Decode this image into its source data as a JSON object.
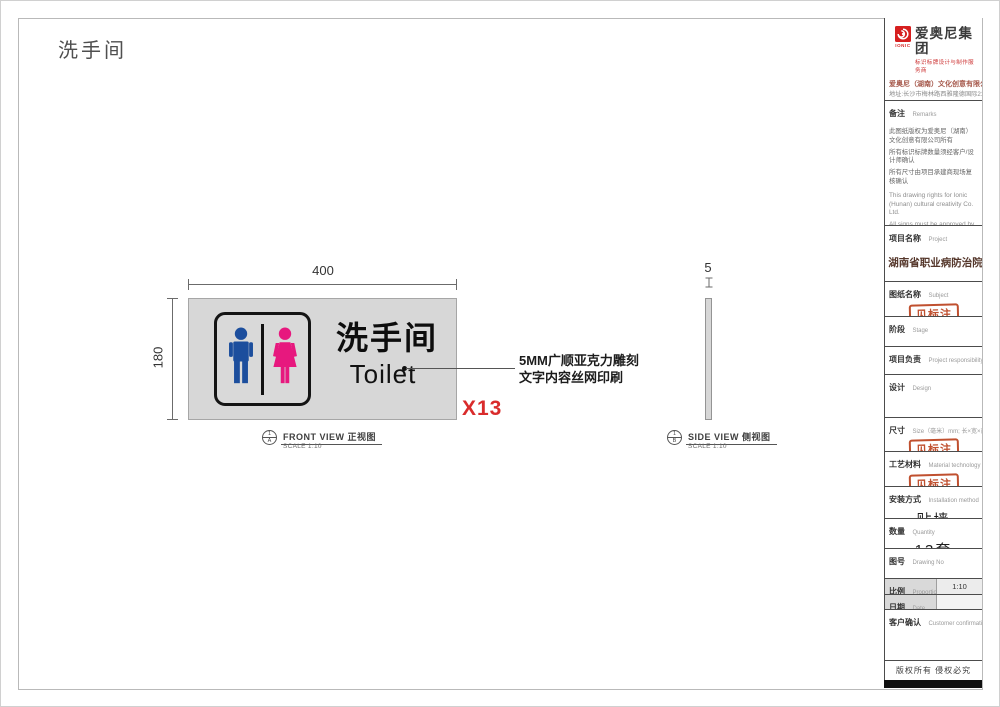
{
  "sheet": {
    "title": "洗手间"
  },
  "front_view": {
    "dim_width": "400",
    "dim_height": "180",
    "sign": {
      "cn": "洗手间",
      "en": "Toilet"
    },
    "annotation": {
      "line1": "5MM广顺亚克力雕刻",
      "line2": "文字内容丝网印刷"
    },
    "quantity_mark": "X13",
    "ref": {
      "num": "1",
      "letter": "A"
    },
    "label": "FRONT VIEW 正视图",
    "scale": "SCALE 1:10"
  },
  "side_view": {
    "dim_thickness": "5",
    "ref": {
      "num": "1",
      "letter": "B"
    },
    "label": "SIDE VIEW 侧视图",
    "scale": "SCALE 1:10"
  },
  "title_block": {
    "header": {
      "brand": "IONIC",
      "group_name": "爱奥尼集团",
      "tagline": "标识标牌设计与制作服务商",
      "company": "爱奥尼（湖南）文化创意有限公司",
      "address": "地址:长沙市梅林路西雅隆德国际2122室",
      "phone": "电话:0731-85074045",
      "website": "http://www.ionic.net.cn"
    },
    "remarks": {
      "label_cn": "备注",
      "label_en": "Remarks",
      "cn": [
        "此图纸版权为爱奥尼（湖南）文化创意有限公司所有",
        "所有标识标牌数量须经客户/设计师确认",
        "所有尺寸由项目承建商现场复核确认"
      ],
      "en": [
        "This drawing rights for Ionic (Hunan) cultural creativity Co. Ltd.",
        "All signs must be approved by the customer / designer to confirm the number of",
        "All dimensions by the project contractors on site review confirmed"
      ]
    },
    "project": {
      "label_cn": "项目名称",
      "label_en": "Project",
      "value": "湖南省职业病防治院"
    },
    "subject": {
      "label_cn": "图纸名称",
      "label_en": "Subject",
      "stamp": "见标注"
    },
    "stage": {
      "label_cn": "阶段",
      "label_en": "Stage",
      "value": ""
    },
    "responsibility": {
      "label_cn": "项目负责",
      "label_en": "Project responsibility",
      "value": ""
    },
    "design": {
      "label_cn": "设计",
      "label_en": "Design",
      "value": ""
    },
    "size": {
      "label_cn": "尺寸",
      "label_en": "Size（毫米）mm; 长×宽×高",
      "stamp": "见标注"
    },
    "material": {
      "label_cn": "工艺材料",
      "label_en": "Material technology",
      "stamp": "见标注"
    },
    "installation": {
      "label_cn": "安装方式",
      "label_en": "Installation method",
      "value": "贴墙"
    },
    "quantity": {
      "label_cn": "数量",
      "label_en": "Quantity",
      "value": "13套"
    },
    "drawing_no": {
      "label_cn": "图号",
      "label_en": "Drawing No",
      "value": ""
    },
    "proportion": {
      "label_cn": "比例",
      "label_en": "Proportion",
      "value": "1:10"
    },
    "date": {
      "label_cn": "日期",
      "label_en": "Date",
      "value": ""
    },
    "customer": {
      "label_cn": "客户确认",
      "label_en": "Customer confirmation",
      "value": ""
    },
    "copyright": "版权所有  侵权必究"
  },
  "colors": {
    "male_blue": "#1c4e9d",
    "female_pink": "#e7187e",
    "accent_red": "#d92b2b",
    "stamp_red": "#c0502f",
    "panel_gray": "#d7d7d7"
  }
}
